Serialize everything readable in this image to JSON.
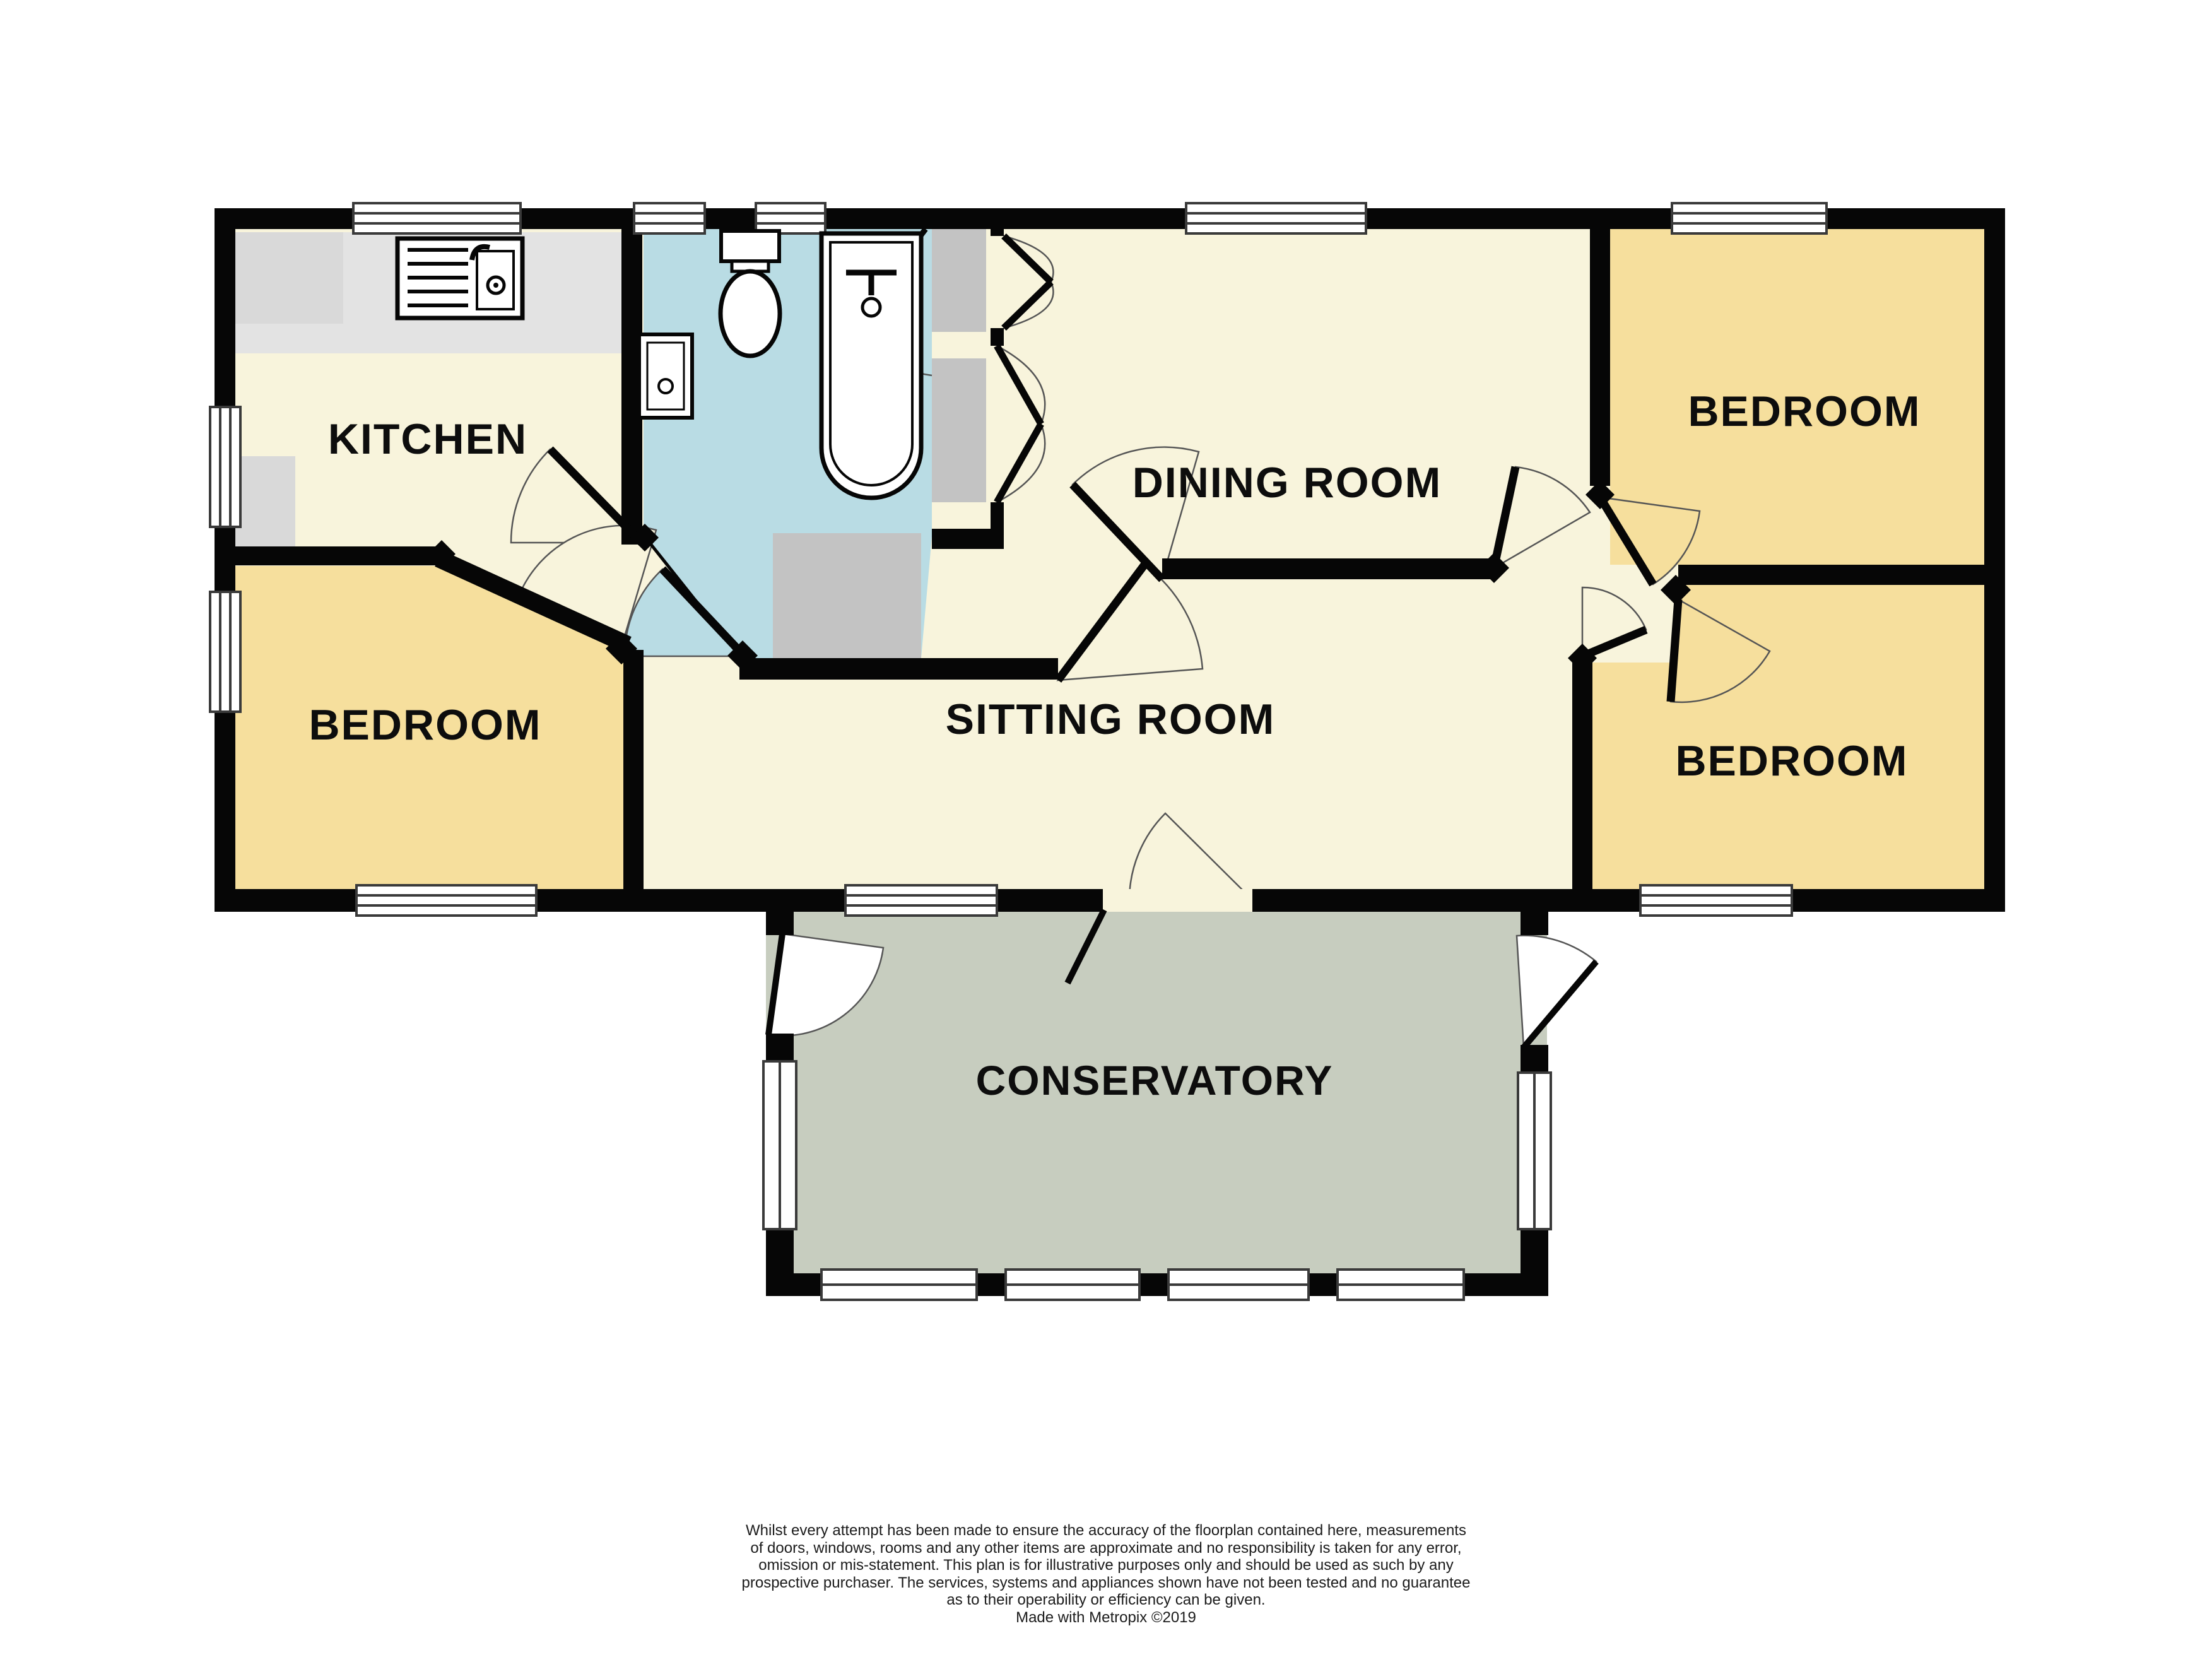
{
  "floorplan": {
    "rooms": {
      "kitchen": {
        "label": "KITCHEN"
      },
      "dining_room": {
        "label": "DINING ROOM"
      },
      "sitting_room": {
        "label": "SITTING ROOM"
      },
      "conservatory": {
        "label": "CONSERVATORY"
      },
      "bedroom_left": {
        "label": "BEDROOM"
      },
      "bedroom_top_right": {
        "label": "BEDROOM"
      },
      "bedroom_bottom_right": {
        "label": "BEDROOM"
      }
    },
    "colors": {
      "wall": "#060606",
      "floor_main": "#F8F4DC",
      "floor_bedroom": "#F6DF9D",
      "floor_bathroom": "#B9DCE4",
      "floor_conservatory": "#C7CDBF",
      "counter_gray": "#D9D9D9",
      "cupboard_gray": "#C3C3C3",
      "window_white": "#FFFFFF"
    },
    "fixtures": {
      "sink": "kitchen-sink",
      "toilet": "toilet",
      "basin": "wash-basin",
      "bath": "bathtub"
    }
  },
  "disclaimer": {
    "lines": [
      "Whilst every attempt has been made to ensure the accuracy of the floorplan contained here, measurements",
      "of doors, windows, rooms and any other items are approximate and no responsibility is taken for any error,",
      "omission or mis-statement. This plan is for illustrative purposes only and should be used as such by any",
      "prospective purchaser. The services, systems and appliances shown have not been tested and no guarantee",
      "as to their operability or efficiency can be given.",
      "Made with Metropix ©2019"
    ]
  }
}
